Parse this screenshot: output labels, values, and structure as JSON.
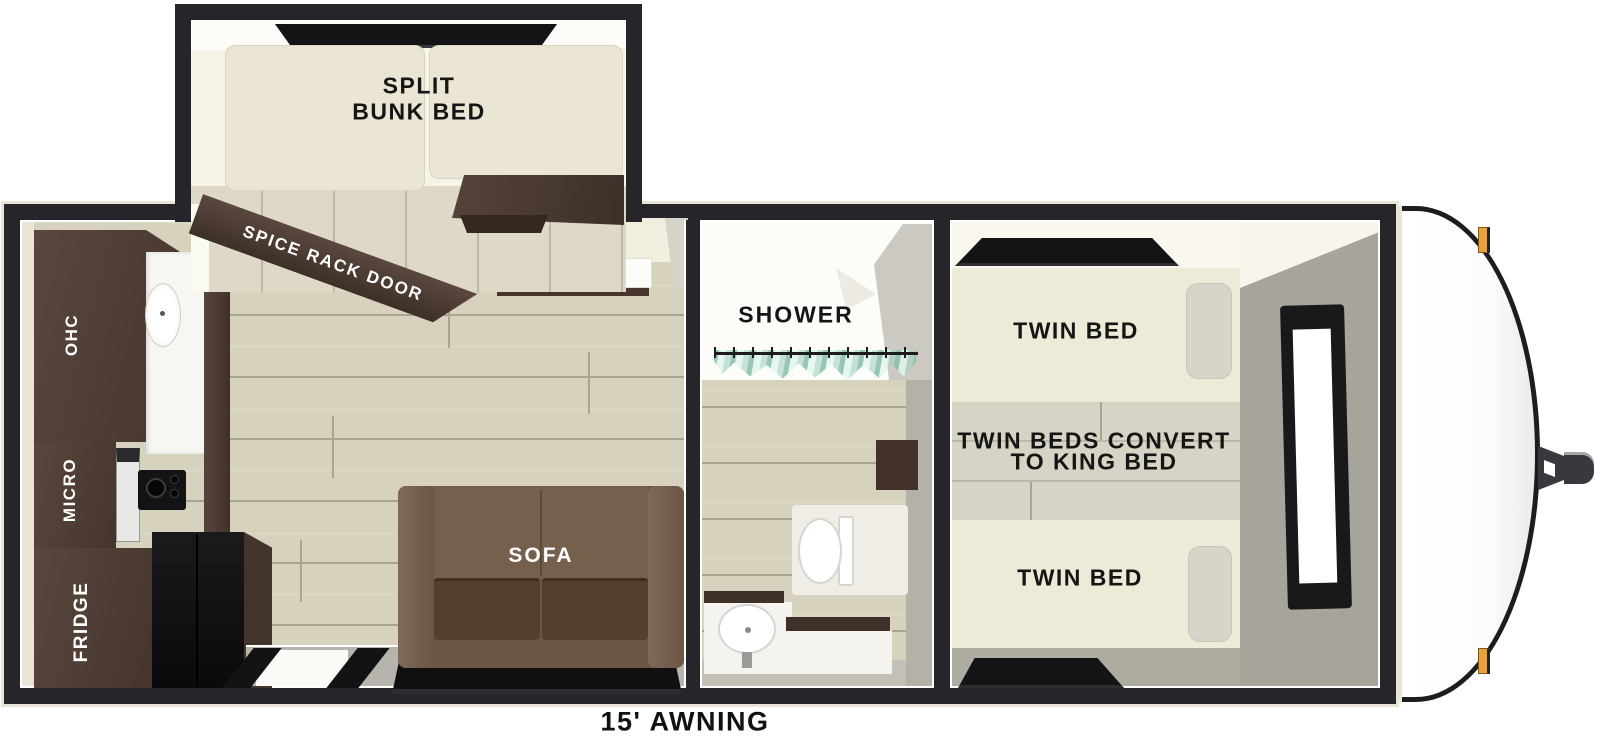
{
  "floorplan": {
    "awning_label": "15' AWNING",
    "bunk_room": {
      "bed_label_line1": "SPLIT",
      "bed_label_line2": "BUNK BED",
      "spice_rack_label": "SPICE RACK DOOR"
    },
    "kitchen": {
      "overhead_cabinet_label": "OHC",
      "microwave_label": "MICRO",
      "fridge_label": "FRIDGE"
    },
    "living_room": {
      "tv_label": "TV",
      "sofa_label": "SOFA"
    },
    "bathroom": {
      "shower_label": "SHOWER"
    },
    "bedroom": {
      "front_twin_label": "TWIN BED",
      "rear_twin_label": "TWIN BED",
      "convert_label_line1": "TWIN BEDS CONVERT",
      "convert_label_line2": "TO KING BED"
    }
  },
  "colors": {
    "wall_dark": "#26262a",
    "trim_cream": "#e9e4d4",
    "floor_wood": "#d6d2be",
    "floor_seam": "#a9a593",
    "cabinet_wood_dark": "#4e3c34",
    "mattress_cream": "#ece7d5",
    "sofa_brown": "#6b5645",
    "bedroom_wall_gray": "#a7a49b",
    "shower_curtain_teal": "#9ccfbd",
    "marker_light_amber": "#e8a43c"
  }
}
